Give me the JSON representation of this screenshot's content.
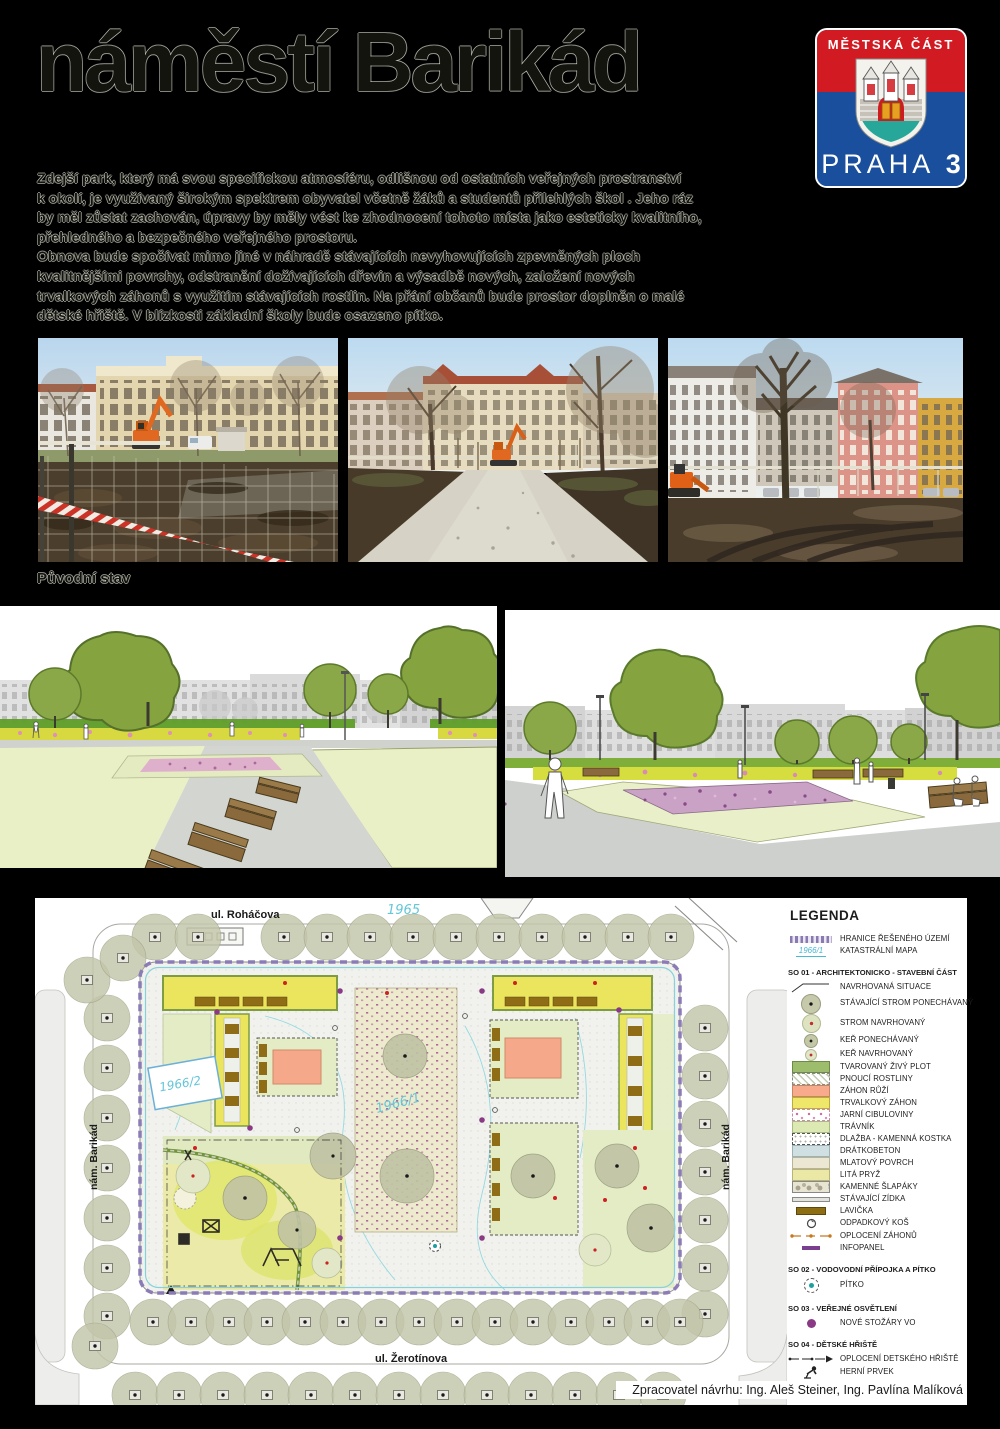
{
  "poster": {
    "title": "náměstí Barikád",
    "photos_caption": "Původní stav",
    "intro_lines": [
      "Zdejší park, který má svou specifickou atmosféru, odlišnou od ostatních veřejných prostranství",
      "k okolí, je využívaný širokým spektrem obyvatel včetně žáků a studentů přilehlých škol . Jeho ráz",
      "by měl zůstat zachován, úpravy by měly vést ke  zhodnocení tohoto místa jako esteticky kvalitního,",
      "přehledného a bezpečného veřejného prostoru.",
      "Obnova bude spočívat mimo jiné v náhradě stávajících nevyhovujících zpevněných ploch",
      "kvalitnějšími povrchy, odstranění dožívajících dřevin a výsadbě nových, založení nových",
      "trvalkových záhonů s využitím stávajících rostlin. Na přání občanů bude prostor doplněn o malé",
      "dětské hřiště. V blízkosti základní školy bude osazeno pítko."
    ]
  },
  "logo": {
    "district_label": "MĚSTSKÁ ČÁST",
    "city": "PRAHA",
    "number": "3",
    "colors": {
      "red": "#d11a21",
      "blue": "#1a4f9e"
    }
  },
  "plan": {
    "streets": {
      "top": "ul. Roháčova",
      "bottom": "ul. Žerotínova",
      "left": "nám. Barikád",
      "right": "nám. Barikád"
    },
    "parcels": {
      "north": "1965",
      "school": "1966/2",
      "park": "1966/1"
    },
    "credit": "Zpracovatel návrhu:  Ing. Aleš Steiner, Ing. Pavlína Malíková"
  },
  "legend": {
    "title": "LEGENDA",
    "general_items": [
      {
        "symbol": "boundary-dashes",
        "label": "HRANICE ŘEŠENÉHO ÚZEMÍ"
      },
      {
        "symbol": "cadastre-line",
        "label": "KATASTRÁLNÍ MAPA",
        "symbol_text": "1966/1"
      }
    ],
    "sections": [
      {
        "heading": "SO 01 - ARCHITEKTONICKO - STAVEBNÍ ČÁST",
        "items": [
          {
            "symbol": "leader-line",
            "label": "NAVRHOVANÁ SITUACE"
          },
          {
            "symbol": "tree-existing",
            "label": "STÁVAJÍCÍ STROM PONECHÁVANÝ"
          },
          {
            "symbol": "tree-proposed",
            "label": "STROM NAVRHOVANÝ"
          },
          {
            "symbol": "shrub-existing",
            "label": "KEŘ PONECHÁVANÝ"
          },
          {
            "symbol": "shrub-proposed",
            "label": "KEŘ NAVRHOVANÝ"
          },
          {
            "symbol": "swatch-hedge",
            "label": "TVAROVANÝ ŽIVÝ PLOT"
          },
          {
            "symbol": "swatch-climbers",
            "label": "PNOUCÍ ROSTLINY"
          },
          {
            "symbol": "swatch-roses",
            "label": "ZÁHON  RŮŽÍ"
          },
          {
            "symbol": "swatch-perennials",
            "label": "TRVALKOVÝ ZÁHON"
          },
          {
            "symbol": "swatch-bulbs",
            "label": "JARNÍ CIBULOVINY"
          },
          {
            "symbol": "swatch-lawn",
            "label": "TRÁVNÍK"
          },
          {
            "symbol": "swatch-cobbles",
            "label": "DLAŽBA - KAMENNÁ KOSTKA"
          },
          {
            "symbol": "swatch-concrete",
            "label": "DRÁTKOBETON"
          },
          {
            "symbol": "swatch-gravel",
            "label": "MLATOVÝ POVRCH"
          },
          {
            "symbol": "swatch-rubber",
            "label": "LITÁ PRYŽ"
          },
          {
            "symbol": "swatch-steppers",
            "label": "KAMENNÉ ŠLAPÁKY"
          },
          {
            "symbol": "wall-line",
            "label": "STÁVAJÍCÍ ZÍDKA"
          },
          {
            "symbol": "bench-bar",
            "label": "LAVIČKA"
          },
          {
            "symbol": "bin-glyph",
            "label": "ODPADKOVÝ KOŠ"
          },
          {
            "symbol": "bed-fence-line",
            "label": "OPLOCENÍ ZÁHONŮ"
          },
          {
            "symbol": "infopanel-bar",
            "label": "INFOPANEL"
          }
        ]
      },
      {
        "heading": "SO 02 - VODOVODNÍ PŘÍPOJKA A PÍTKO",
        "items": [
          {
            "symbol": "fountain-glyph",
            "label": "PÍTKO"
          }
        ]
      },
      {
        "heading": "SO 03 - VEŘEJNÉ OSVĚTLENÍ",
        "items": [
          {
            "symbol": "lamp-dot",
            "label": "NOVÉ STOŽÁRY VO"
          }
        ]
      },
      {
        "heading": "SO 04 - DĚTSKÉ HŘIŠTĚ",
        "items": [
          {
            "symbol": "playground-fence-line",
            "label": "OPLOCENÍ DETSKÉHO HŘIŠTĚ"
          },
          {
            "symbol": "play-equipment-glyph",
            "label": "HERNÍ PRVEK"
          }
        ]
      }
    ]
  }
}
